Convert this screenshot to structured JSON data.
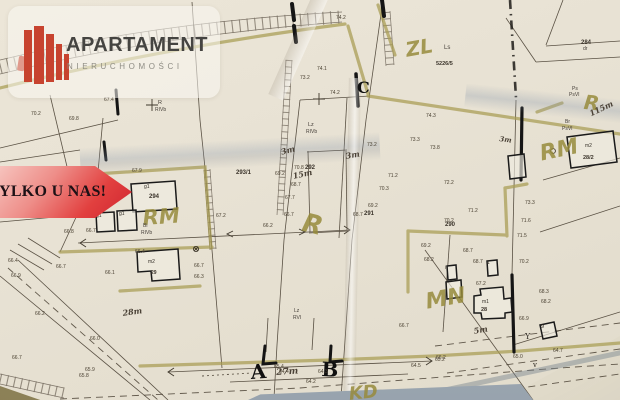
{
  "branding": {
    "title": "APARTAMENT",
    "subtitle": "NIERUCHOMOŚCI",
    "accent_color": "#c7432f"
  },
  "banner": {
    "text": "TYLKO U NAS!",
    "gradient_start": "#f6c3bd",
    "gradient_end": "#cf2530"
  },
  "map": {
    "ink_color": "#4a4134",
    "highlight_color": "#9a8f3e",
    "zone_labels": [
      {
        "t": "ZL",
        "x": 404,
        "y": 40,
        "s": 20,
        "r": -10
      },
      {
        "t": "R",
        "x": 585,
        "y": 92,
        "s": 20,
        "r": 6
      },
      {
        "t": "RM",
        "x": 538,
        "y": 144,
        "s": 22,
        "r": -12
      },
      {
        "t": "RM",
        "x": 142,
        "y": 208,
        "s": 21,
        "r": -4
      },
      {
        "t": "R",
        "x": 306,
        "y": 210,
        "s": 26,
        "r": 14
      },
      {
        "t": "MN",
        "x": 424,
        "y": 292,
        "s": 22,
        "r": -10
      },
      {
        "t": "KD",
        "x": 348,
        "y": 386,
        "s": 18,
        "r": -6
      }
    ],
    "section_letters": [
      {
        "t": "C",
        "x": 357,
        "y": 80,
        "s": 16,
        "r": 0
      },
      {
        "t": "A",
        "x": 250,
        "y": 362,
        "s": 20,
        "r": -4
      },
      {
        "t": "B",
        "x": 322,
        "y": 359,
        "s": 20,
        "r": 3
      }
    ],
    "measurements": [
      {
        "t": "3m",
        "x": 280,
        "y": 148,
        "s": 8,
        "r": -15
      },
      {
        "t": "3m",
        "x": 345,
        "y": 152,
        "s": 8,
        "r": -10
      },
      {
        "t": "15m",
        "x": 292,
        "y": 172,
        "s": 8,
        "r": -12
      },
      {
        "t": "28m",
        "x": 122,
        "y": 309,
        "s": 8,
        "r": -8
      },
      {
        "t": "5m",
        "x": 473,
        "y": 327,
        "s": 8,
        "r": -10
      },
      {
        "t": "27m",
        "x": 276,
        "y": 369,
        "s": 9,
        "r": -4
      },
      {
        "t": "115m",
        "x": 588,
        "y": 110,
        "s": 8,
        "r": -25
      },
      {
        "t": "3m",
        "x": 500,
        "y": 135,
        "s": 7,
        "r": 8
      }
    ],
    "parcel_numbers": [
      {
        "t": "284",
        "x": 581,
        "y": 40,
        "s": 6
      },
      {
        "t": "5226/5",
        "x": 436,
        "y": 62,
        "s": 5.5
      },
      {
        "t": "293/1",
        "x": 236,
        "y": 170,
        "s": 6
      },
      {
        "t": "292",
        "x": 305,
        "y": 165,
        "s": 6
      },
      {
        "t": "291",
        "x": 364,
        "y": 211,
        "s": 6
      },
      {
        "t": "290",
        "x": 445,
        "y": 222,
        "s": 6
      },
      {
        "t": "294",
        "x": 149,
        "y": 194,
        "s": 6
      },
      {
        "t": "28/2",
        "x": 583,
        "y": 156,
        "s": 5.5
      },
      {
        "t": "29",
        "x": 151,
        "y": 271,
        "s": 5
      },
      {
        "t": "28",
        "x": 481,
        "y": 308,
        "s": 5.5
      }
    ],
    "land_use_labels": [
      {
        "t": "Ls",
        "x": 444,
        "y": 45,
        "s": 6
      },
      {
        "t": "dr",
        "x": 583,
        "y": 47,
        "s": 5
      },
      {
        "t": "Ps",
        "x": 572,
        "y": 87,
        "s": 5
      },
      {
        "t": "PsVI",
        "x": 569,
        "y": 93,
        "s": 5
      },
      {
        "t": "Br",
        "x": 565,
        "y": 120,
        "s": 5
      },
      {
        "t": "PsVI",
        "x": 562,
        "y": 127,
        "s": 5
      },
      {
        "t": "Lz",
        "x": 308,
        "y": 123,
        "s": 5.5
      },
      {
        "t": "RIVb",
        "x": 306,
        "y": 130,
        "s": 5
      },
      {
        "t": "R",
        "x": 158,
        "y": 101,
        "s": 5.5
      },
      {
        "t": "RIVb",
        "x": 155,
        "y": 108,
        "s": 5
      },
      {
        "t": "Bi",
        "x": 143,
        "y": 224,
        "s": 5
      },
      {
        "t": "RIVb",
        "x": 141,
        "y": 231,
        "s": 5
      },
      {
        "t": "Lz",
        "x": 294,
        "y": 309,
        "s": 5
      },
      {
        "t": "RVI",
        "x": 293,
        "y": 316,
        "s": 5
      }
    ],
    "building_labels": [
      {
        "t": "g1",
        "x": 144,
        "y": 185,
        "s": 5
      },
      {
        "t": "g1",
        "x": 96,
        "y": 214,
        "s": 5
      },
      {
        "t": "g1",
        "x": 119,
        "y": 212,
        "s": 5
      },
      {
        "t": "m2",
        "x": 148,
        "y": 260,
        "s": 5
      },
      {
        "t": "m2",
        "x": 585,
        "y": 144,
        "s": 5
      },
      {
        "t": "m1",
        "x": 482,
        "y": 300,
        "s": 5
      },
      {
        "t": "i",
        "x": 445,
        "y": 266,
        "s": 5
      },
      {
        "t": "i",
        "x": 446,
        "y": 283,
        "s": 5
      },
      {
        "t": "1",
        "x": 487,
        "y": 261,
        "s": 5
      },
      {
        "t": "9",
        "x": 541,
        "y": 325,
        "s": 5.5
      }
    ],
    "spot_heights": [
      {
        "v": "74.1",
        "x": 317,
        "y": 67
      },
      {
        "v": "73.2",
        "x": 300,
        "y": 76
      },
      {
        "v": "74.2",
        "x": 330,
        "y": 91
      },
      {
        "v": "74.2",
        "x": 336,
        "y": 16
      },
      {
        "v": "74.3",
        "x": 426,
        "y": 114
      },
      {
        "v": "73.3",
        "x": 410,
        "y": 138
      },
      {
        "v": "73.2",
        "x": 367,
        "y": 143
      },
      {
        "v": "73.8",
        "x": 430,
        "y": 146
      },
      {
        "v": "72.2",
        "x": 444,
        "y": 181
      },
      {
        "v": "71.2",
        "x": 468,
        "y": 209
      },
      {
        "v": "70.2",
        "x": 444,
        "y": 219
      },
      {
        "v": "71.6",
        "x": 521,
        "y": 219
      },
      {
        "v": "71.5",
        "x": 517,
        "y": 234
      },
      {
        "v": "73.3",
        "x": 525,
        "y": 201
      },
      {
        "v": "70.8",
        "x": 294,
        "y": 166
      },
      {
        "v": "69.2",
        "x": 275,
        "y": 172
      },
      {
        "v": "68.7",
        "x": 291,
        "y": 183
      },
      {
        "v": "67.7",
        "x": 285,
        "y": 196
      },
      {
        "v": "66.7",
        "x": 284,
        "y": 213
      },
      {
        "v": "66.2",
        "x": 263,
        "y": 224
      },
      {
        "v": "71.2",
        "x": 388,
        "y": 174
      },
      {
        "v": "70.3",
        "x": 379,
        "y": 187
      },
      {
        "v": "69.2",
        "x": 368,
        "y": 204
      },
      {
        "v": "68.7",
        "x": 353,
        "y": 213
      },
      {
        "v": "69.2",
        "x": 421,
        "y": 244
      },
      {
        "v": "68.2",
        "x": 424,
        "y": 258
      },
      {
        "v": "68.7",
        "x": 463,
        "y": 249
      },
      {
        "v": "68.7",
        "x": 473,
        "y": 260
      },
      {
        "v": "67.2",
        "x": 476,
        "y": 282
      },
      {
        "v": "68.3",
        "x": 539,
        "y": 290
      },
      {
        "v": "68.2",
        "x": 541,
        "y": 300
      },
      {
        "v": "66.9",
        "x": 519,
        "y": 317
      },
      {
        "v": "70.2",
        "x": 519,
        "y": 260
      },
      {
        "v": "64.5",
        "x": 411,
        "y": 364
      },
      {
        "v": "65.0",
        "x": 513,
        "y": 355
      },
      {
        "v": "64.7",
        "x": 553,
        "y": 349
      },
      {
        "v": "66.2",
        "x": 436,
        "y": 356
      },
      {
        "v": "65.4",
        "x": 274,
        "y": 365
      },
      {
        "v": "64.4",
        "x": 279,
        "y": 370
      },
      {
        "v": "64.3",
        "x": 318,
        "y": 370
      },
      {
        "v": "64.2",
        "x": 306,
        "y": 380
      },
      {
        "v": "66.7",
        "x": 399,
        "y": 324
      },
      {
        "v": "67.9",
        "x": 132,
        "y": 169
      },
      {
        "v": "66.7",
        "x": 86,
        "y": 229
      },
      {
        "v": "66.4",
        "x": 135,
        "y": 250
      },
      {
        "v": "66.1",
        "x": 105,
        "y": 271
      },
      {
        "v": "67.2",
        "x": 216,
        "y": 214
      },
      {
        "v": "66.7",
        "x": 194,
        "y": 264
      },
      {
        "v": "66.3",
        "x": 194,
        "y": 275
      },
      {
        "v": "66.4",
        "x": 8,
        "y": 259
      },
      {
        "v": "66.7",
        "x": 56,
        "y": 265
      },
      {
        "v": "66.9",
        "x": 11,
        "y": 274
      },
      {
        "v": "66.2",
        "x": 35,
        "y": 312
      },
      {
        "v": "66.0",
        "x": 90,
        "y": 337
      },
      {
        "v": "65.9",
        "x": 85,
        "y": 368
      },
      {
        "v": "65.8",
        "x": 79,
        "y": 374
      },
      {
        "v": "66.7",
        "x": 12,
        "y": 356
      },
      {
        "v": "65.2",
        "x": 435,
        "y": 358
      },
      {
        "v": "67.4",
        "x": 104,
        "y": 98
      },
      {
        "v": "70.2",
        "x": 31,
        "y": 112
      },
      {
        "v": "69.8",
        "x": 69,
        "y": 117
      },
      {
        "v": "66.8",
        "x": 64,
        "y": 230
      }
    ],
    "symbols": [
      {
        "t": "Y",
        "x": 525,
        "y": 333,
        "s": 8
      },
      {
        "t": "v",
        "x": 533,
        "y": 362,
        "s": 7
      }
    ]
  }
}
